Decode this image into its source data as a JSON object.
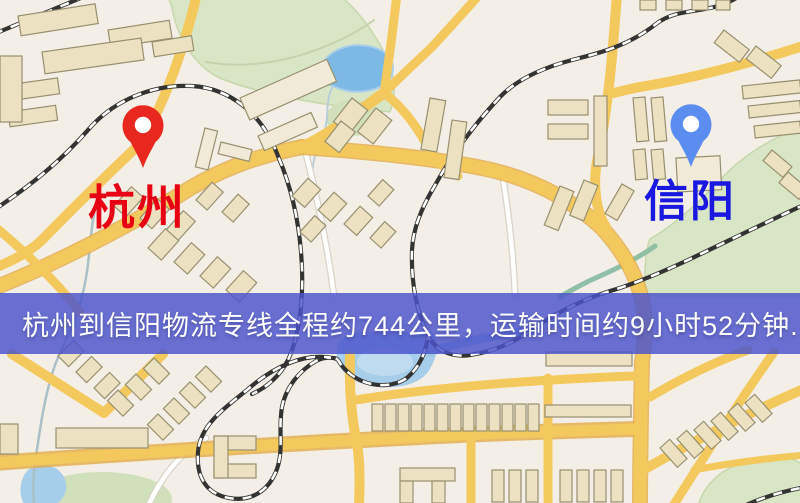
{
  "map": {
    "kind": "logistics-route-map",
    "origin": {
      "name": "杭州",
      "label_color": "#e60012",
      "pin_color": "#e8281e",
      "icon": "map-pin"
    },
    "destination": {
      "name": "信阳",
      "label_color": "#1a18e0",
      "pin_color": "#5b8cf0",
      "icon": "map-pin"
    },
    "banner": {
      "text": "杭州到信阳物流专线全程约744公里，运输时间约9小时52分钟.",
      "background_color": "#4c54cd",
      "text_color": "#ffffff",
      "distance_km": "744",
      "duration_text": "约9小时52分钟"
    },
    "palette": {
      "land": "#f4efe6",
      "road_major": "#f3c95e",
      "road_minor": "#ffffff",
      "park_green": "#d8e6c5",
      "water_blue": "#7cb9e4",
      "building_fill": "#ece1c1",
      "railway_dark": "#333333"
    }
  }
}
